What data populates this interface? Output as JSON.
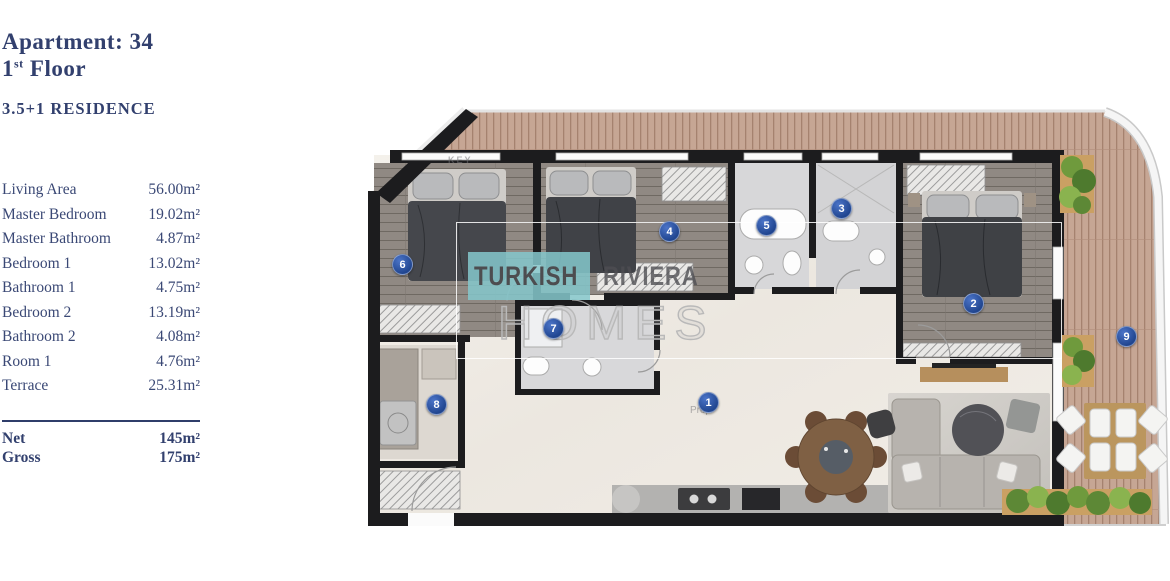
{
  "sidebar": {
    "apartment_label": "Apartment: 34",
    "floor": {
      "num": "1",
      "sup": "st",
      "word": " Floor"
    },
    "residence_type": "3.5+1 RESIDENCE",
    "rooms": [
      {
        "label": "Living Area",
        "value": "56.00m²"
      },
      {
        "label": "Master Bedroom",
        "value": "19.02m²"
      },
      {
        "label": "Master Bathroom",
        "value": "4.87m²"
      },
      {
        "label": "Bedroom 1",
        "value": "13.02m²"
      },
      {
        "label": "Bathroom 1",
        "value": "4.75m²"
      },
      {
        "label": "Bedroom 2",
        "value": "13.19m²"
      },
      {
        "label": "Bathroom 2",
        "value": "4.08m²"
      },
      {
        "label": "Room 1",
        "value": "4.76m²"
      },
      {
        "label": "Terrace",
        "value": "25.31m²"
      }
    ],
    "summary": [
      {
        "label": "Net",
        "value": "145m²"
      },
      {
        "label": "Gross",
        "value": "175m²"
      }
    ]
  },
  "floorplan": {
    "markers": [
      "1",
      "2",
      "3",
      "4",
      "5",
      "6",
      "7",
      "8",
      "9"
    ],
    "watermark": {
      "word1": "TURKISH",
      "word2": "RIVIERA",
      "word3": "HOMES"
    },
    "faint_labels": {
      "key": "KEY",
      "prop": "Prop"
    }
  },
  "colors": {
    "navy": "#32406e",
    "marker_blue": "#27509f",
    "teal": "#85c8cd",
    "deck_wood": "#c6a694",
    "bedroom_wood": "#908983"
  }
}
